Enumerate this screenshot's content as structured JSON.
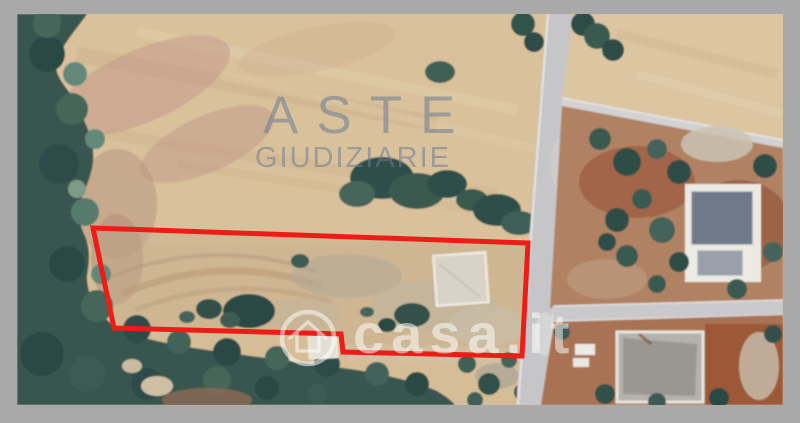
{
  "watermarks": {
    "aste": {
      "line1": "ASTE",
      "line2": "GIUDIZIARIE",
      "color": "rgba(105,124,148,0.55)"
    },
    "casa": {
      "text": "casa.it",
      "color": "rgba(255,255,255,0.52)"
    }
  },
  "boundary": {
    "color": "#ed1c16",
    "stroke_width": 5,
    "points": "76,214 511,229 505,342 326,338 324,320 97,314"
  }
}
